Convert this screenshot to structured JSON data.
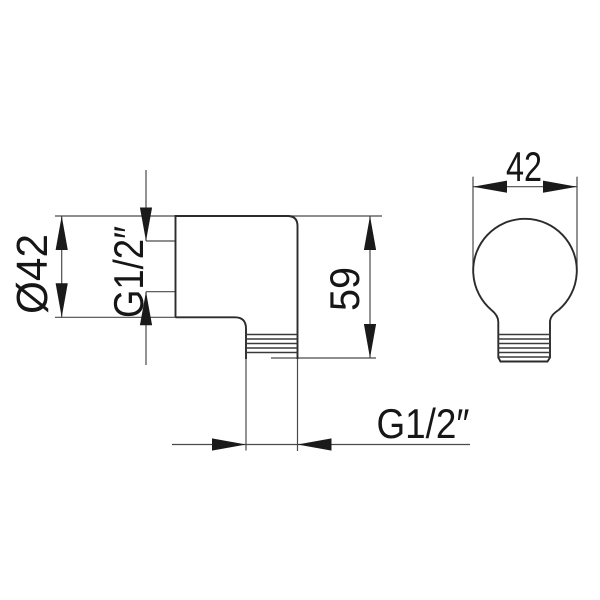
{
  "drawing": {
    "type": "technical-drawing",
    "colors": {
      "background": "#ffffff",
      "outline": "#2b2b2b",
      "dimension_lines": "#4a4a4a",
      "text": "#161616"
    },
    "views": {
      "side_view": {
        "dimensions": {
          "flange_diameter": "Ø42",
          "inlet_thread": "G1/2″",
          "height": "59",
          "outlet_thread": "G1/2″"
        }
      },
      "front_view": {
        "dimensions": {
          "width": "42"
        }
      }
    }
  }
}
